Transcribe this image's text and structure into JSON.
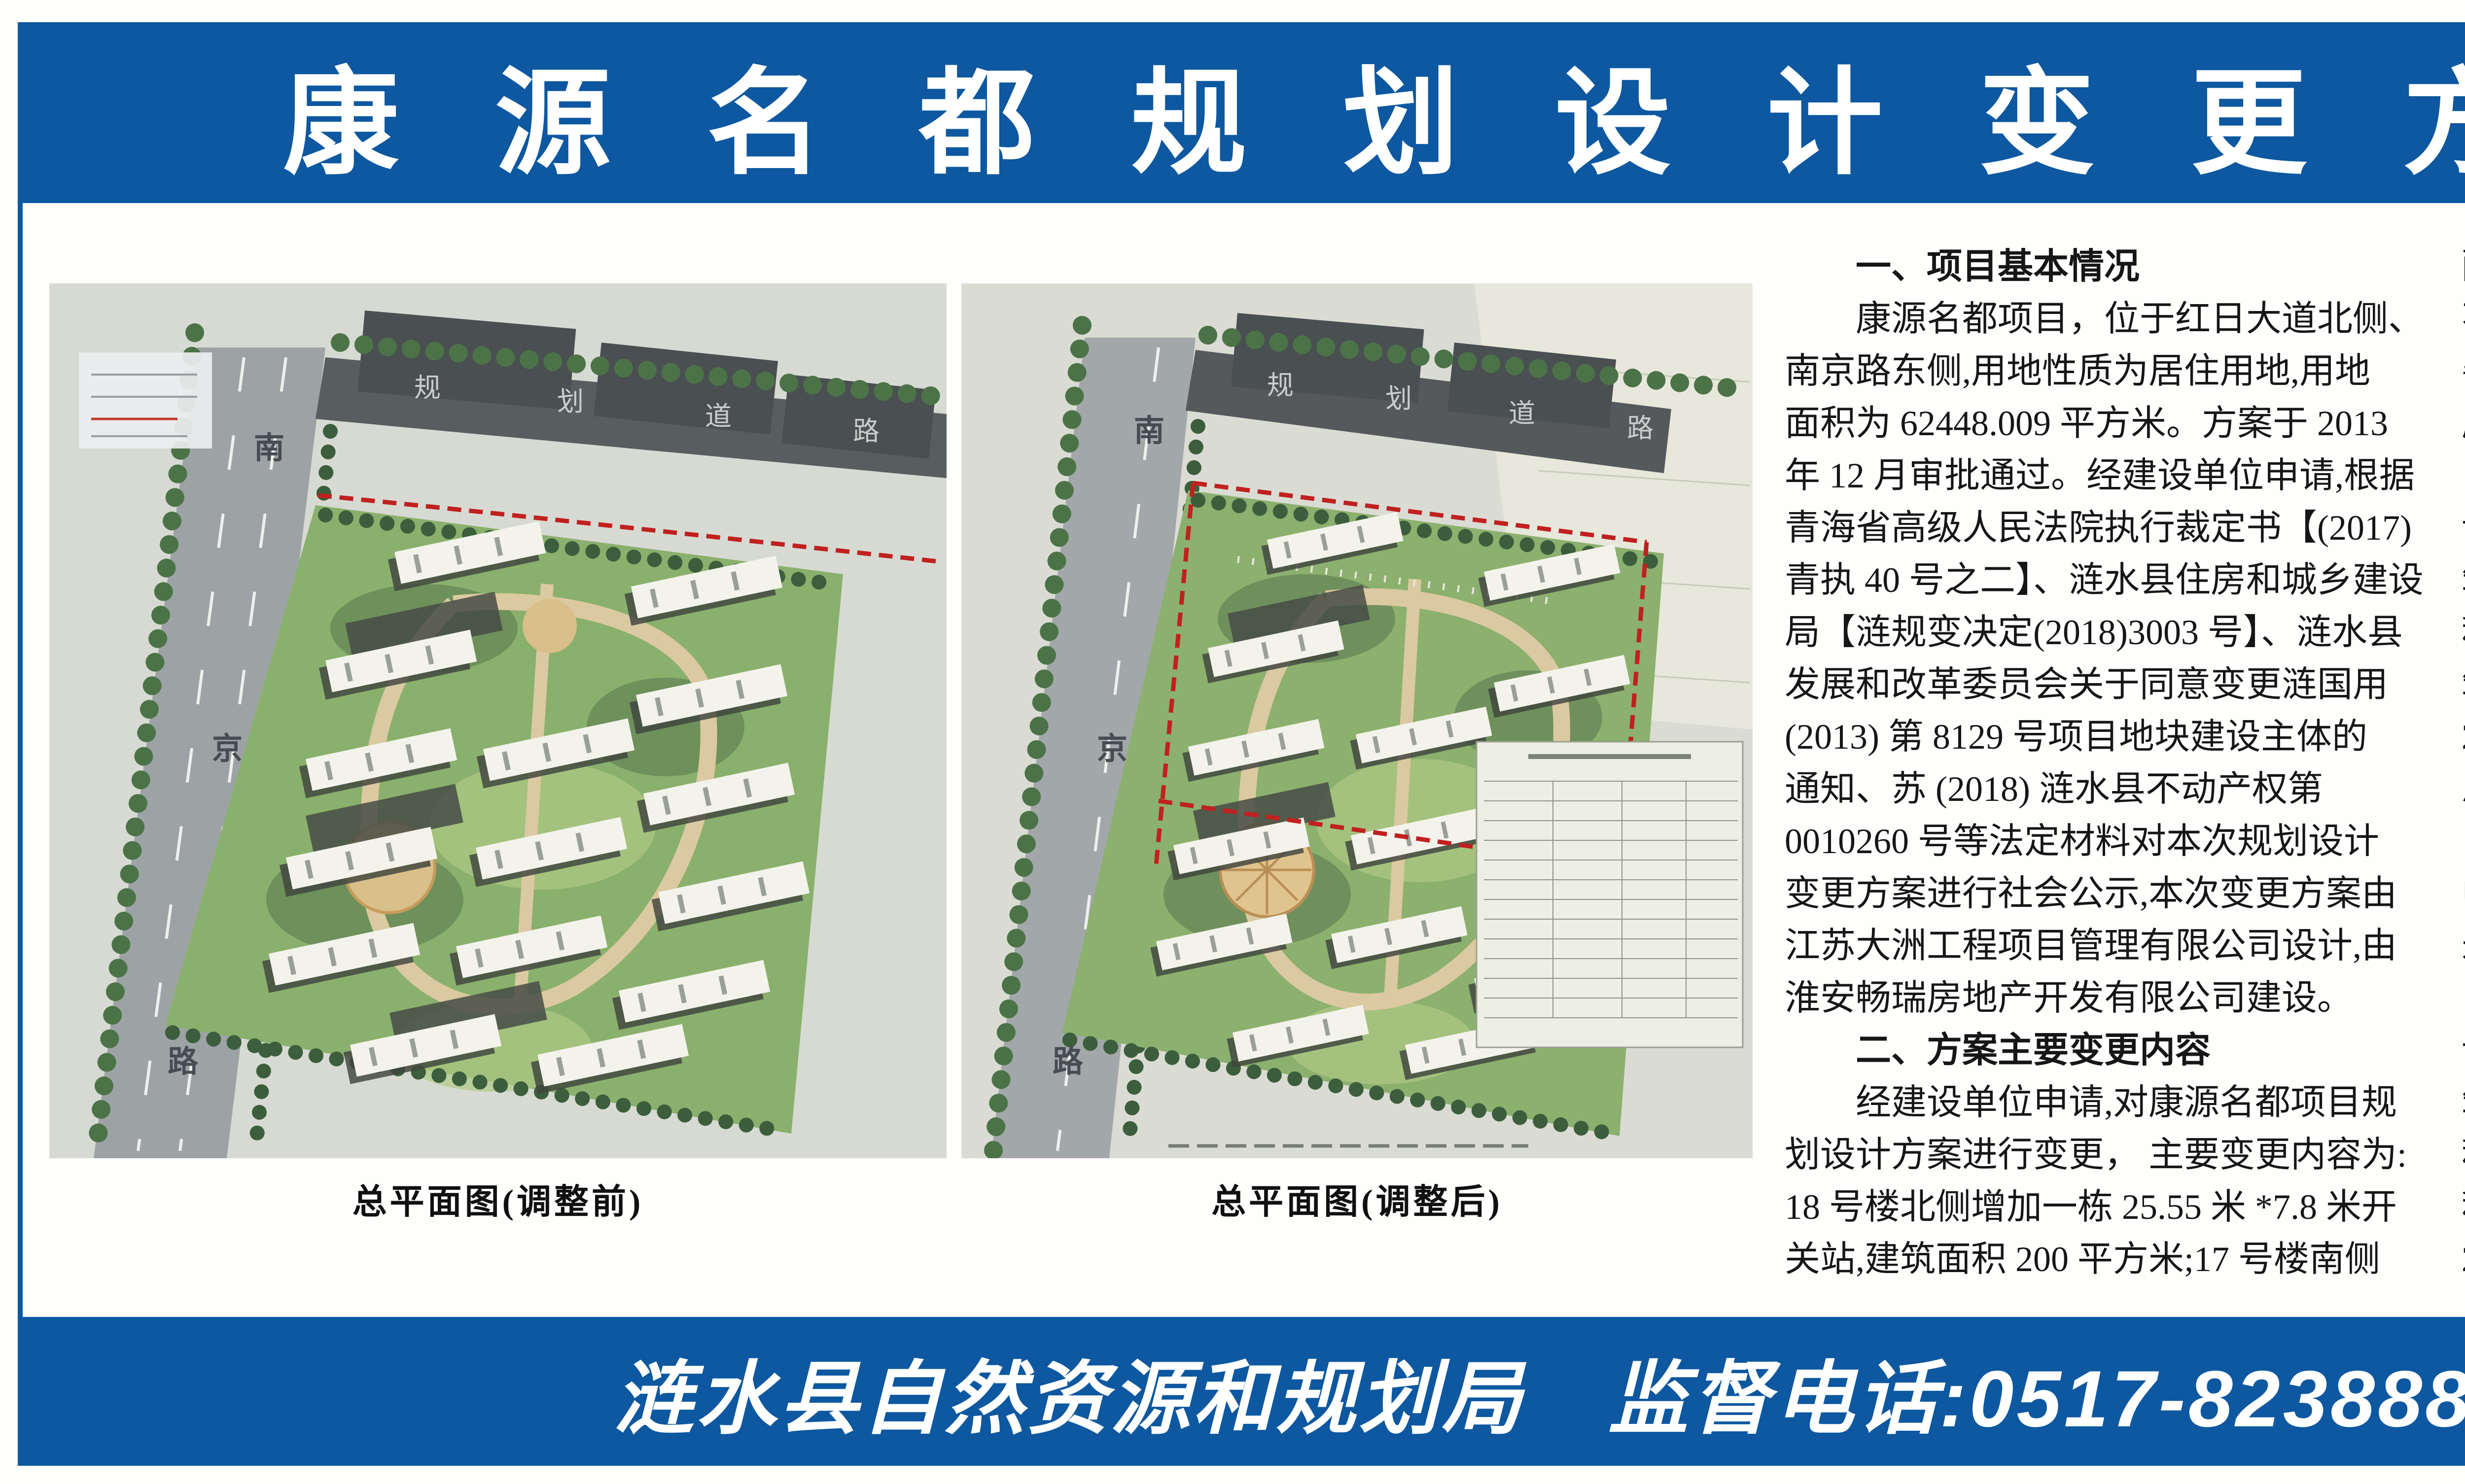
{
  "header": {
    "title": "康源名都规划设计变更方案批前公示",
    "banner_color": "#0d58a0"
  },
  "plans": {
    "caption_before": "总平面图(调整前)",
    "caption_after": "总平面图(调整后)",
    "side_road_chars": [
      "南",
      "京",
      "路"
    ],
    "top_road_chars": [
      "规",
      "划",
      "道",
      "路"
    ]
  },
  "columns": {
    "col1": [
      {
        "c": "h",
        "t": "　　一、项目基本情况"
      },
      {
        "c": "p",
        "t": "　　康源名都项目，位于红日大道北侧、"
      },
      {
        "c": "p",
        "t": "南京路东侧,用地性质为居住用地,用地"
      },
      {
        "c": "p",
        "t": "面积为 62448.009 平方米。方案于 2013"
      },
      {
        "c": "p",
        "t": "年 12 月审批通过。经建设单位申请,根据"
      },
      {
        "c": "p",
        "t": "青海省高级人民法院执行裁定书【(2017)"
      },
      {
        "c": "p",
        "t": "青执 40 号之二】、涟水县住房和城乡建设"
      },
      {
        "c": "p",
        "t": "局【涟规变决定(2018)3003 号】、涟水县"
      },
      {
        "c": "p",
        "t": "发展和改革委员会关于同意变更涟国用"
      },
      {
        "c": "p",
        "t": "(2013) 第 8129 号项目地块建设主体的"
      },
      {
        "c": "p",
        "t": "通知、苏 (2018) 涟水县不动产权第"
      },
      {
        "c": "p",
        "t": "0010260 号等法定材料对本次规划设计"
      },
      {
        "c": "p",
        "t": "变更方案进行社会公示,本次变更方案由"
      },
      {
        "c": "p",
        "t": "江苏大洲工程项目管理有限公司设计,由"
      },
      {
        "c": "p",
        "t": "淮安畅瑞房地产开发有限公司建设。"
      },
      {
        "c": "h",
        "t": "　　二、方案主要变更内容"
      },
      {
        "c": "p",
        "t": "　　经建设单位申请,对康源名都项目规"
      },
      {
        "c": "p",
        "t": "划设计方案进行变更， 主要变更内容为:"
      },
      {
        "c": "p",
        "t": "18 号楼北侧增加一栋 25.55 米 *7.8 米开"
      },
      {
        "c": "p",
        "t": "关站,建筑面积 200 平方米;17 号楼南侧"
      }
    ],
    "col2": [
      {
        "c": "p",
        "t": "配电房由南北向调整为东西向,尺寸保持"
      },
      {
        "c": "p",
        "t": "不变; 在各项指标数据不变的情况下,完"
      },
      {
        "c": "p",
        "t": "善总平面各幢建筑正负零标高及地下车"
      },
      {
        "c": "p",
        "t": "库轮廓线;地面景观进行局部调整。"
      },
      {
        "c": "p",
        "t": "　　变更前主要经济技术指标:项目建"
      },
      {
        "c": "p",
        "t": "设用地总面积 62448.009 平方米,总建"
      },
      {
        "c": "p",
        "t": "筑面积 182873.12 平方米 （其中计算容"
      },
      {
        "c": "p",
        "t": "积率面积 152523.81 平方米， 不计容建"
      },
      {
        "c": "p",
        "t": "筑面积 30349.31 平方米）， 容积率"
      },
      {
        "c": "p",
        "t": "2.44,建筑密度 18.38%,绿地率 31.2%,"
      },
      {
        "c": "p",
        "t": "总户数 1333 户,机动车停车位 1361 辆"
      },
      {
        "c": "p",
        "t": "（其中商业 28 辆、住宅 1333 辆）。项目"
      },
      {
        "c": "p",
        "t": "中包含物业管理服务用房 740.2 平方"
      },
      {
        "c": "p",
        "t": "米,社区党群服务用房 374.48 平方米。"
      },
      {
        "c": "p",
        "t": "　　变更后主要经济技术指标:项目建"
      },
      {
        "c": "p",
        "t": "设用地总面积 62448.009 平方米,总建"
      },
      {
        "c": "p",
        "t": "筑面积 183260.05 平方米(其中计算容"
      },
      {
        "c": "p",
        "t": "积率面积 152716.75 平方米， 不计算容"
      },
      {
        "c": "p",
        "t": "积率面积 30543.3 平方米）， 容积率"
      },
      {
        "c": "p",
        "t": "2.45,建筑密度 18.71%,绿地率 30.2%,"
      }
    ],
    "col3": [
      {
        "c": "p",
        "t": "总户数 1333 户,机动车停车位 1361 辆"
      },
      {
        "c": "p",
        "t": "（其中商业 28 辆、住宅 1333 辆）。项目"
      },
      {
        "c": "p",
        "t": "中包含物业管理服务用房 740.2 平方"
      },
      {
        "c": "p",
        "t": "米,社区党群服务用房 374.48 平方米。"
      },
      {
        "c": "p",
        "t": "　　现对该规划设计方案进行批前公示"
      },
      {
        "c": "p",
        "t": "（详见公示附图）， 公示时间为 2020 年"
      },
      {
        "c": "p",
        "t": "12 月 31 日至 2021 年 1 月 14 日。"
      },
      {
        "c": "h",
        "t": "　　三、公示载体"
      },
      {
        "c": "p",
        "t": "　　1.《涟水日报》;"
      },
      {
        "c": "p",
        "t": "　　2. 中国涟水政府门户网站 http:"
      },
      {
        "c": "p",
        "t": "//www.lianshui.gov.cn/;"
      },
      {
        "c": "p",
        "t": "　　3.批准的建设用地现场。"
      },
      {
        "c": "p",
        "t": "　　如对方案有不同意见或建议， 请于"
      },
      {
        "c": "p",
        "t": "2021 年 1 月 14 日前，以书面形式向县"
      },
      {
        "c": "p",
        "t": "自然资源和规划局反映， 或者向局法规"
      },
      {
        "c": "p",
        "t": "科提出听证申请。"
      },
      {
        "c": "p",
        "t": "　　联系人:皇月荣、陈铁"
      },
      {
        "c": "p",
        "t": "　　联系电话:0517-82388806、"
      },
      {
        "c": "p",
        "t": "　　　　　　　　0517-82380262"
      },
      {
        "c": "p",
        "t": "　　　　　　　　2020 年 12 月 31 日"
      }
    ]
  },
  "footer": {
    "agency": "涟水县自然资源和规划局",
    "phone": "监督电话:0517-82388806、0517-82380262"
  }
}
